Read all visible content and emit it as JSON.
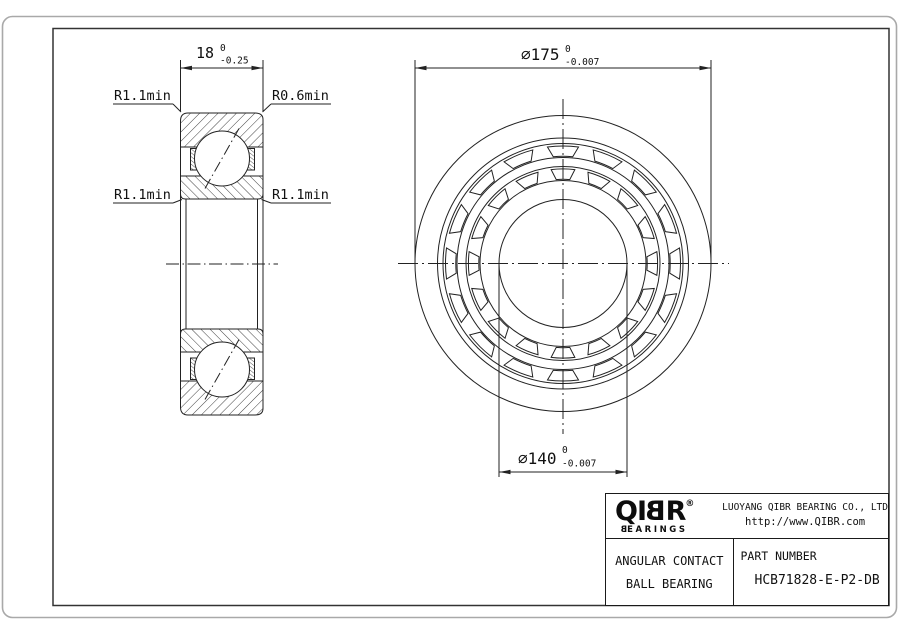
{
  "section_view": {
    "dim_width": {
      "value": "18",
      "tol_top": "0",
      "tol_bottom": "-0.25"
    },
    "label_top_left": "R1.1min",
    "label_top_right": "R0.6min",
    "label_mid_left": "R1.1min",
    "label_mid_right": "R1.1min"
  },
  "front_view": {
    "dim_outer": {
      "value": "∅175",
      "tol_top": "0",
      "tol_bottom": "-0.007"
    },
    "dim_bore": {
      "value": "∅140",
      "tol_top": "0",
      "tol_bottom": "-0.007"
    }
  },
  "title_block": {
    "logo": {
      "letters": [
        "Q",
        "I",
        "B",
        "R"
      ],
      "registered": "®",
      "sub_first": "B",
      "sub_rest": "EARINGS"
    },
    "company": "LUOYANG QIBR BEARING CO., LTD",
    "website": "http://www.QIBR.com",
    "product": {
      "line1": "ANGULAR CONTACT",
      "line2": "BALL BEARING"
    },
    "part": {
      "label": "PART NUMBER",
      "number": "HCB71828-E-P2-DB"
    }
  }
}
